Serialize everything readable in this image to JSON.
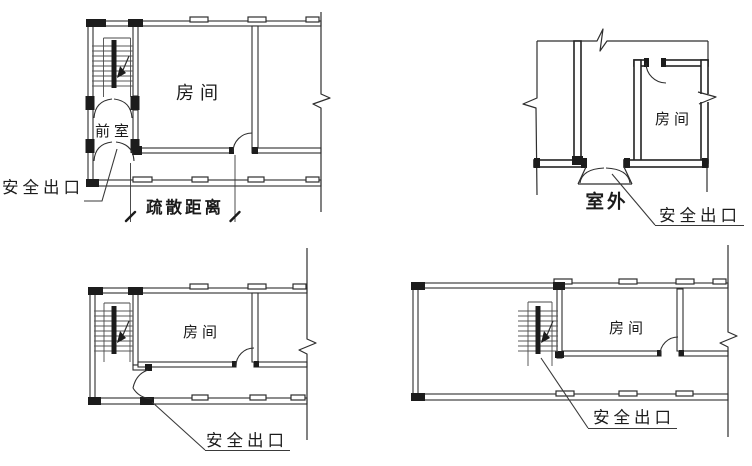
{
  "figure": {
    "background": "#ffffff",
    "line_color": "#2e2e2e",
    "dark_fill": "#1c1c1c",
    "tread_color": "#5a5a5a"
  },
  "diagrams": {
    "top_left": {
      "room": "房间",
      "anteroom": "前室",
      "exit": "安全出口",
      "dimension": "疏散距离"
    },
    "top_right": {
      "room": "房间",
      "outdoor": "室外",
      "exit": "安全出口"
    },
    "bottom_left": {
      "room": "房间",
      "exit": "安全出口"
    },
    "bottom_right": {
      "room": "房间",
      "exit": "安全出口"
    }
  }
}
